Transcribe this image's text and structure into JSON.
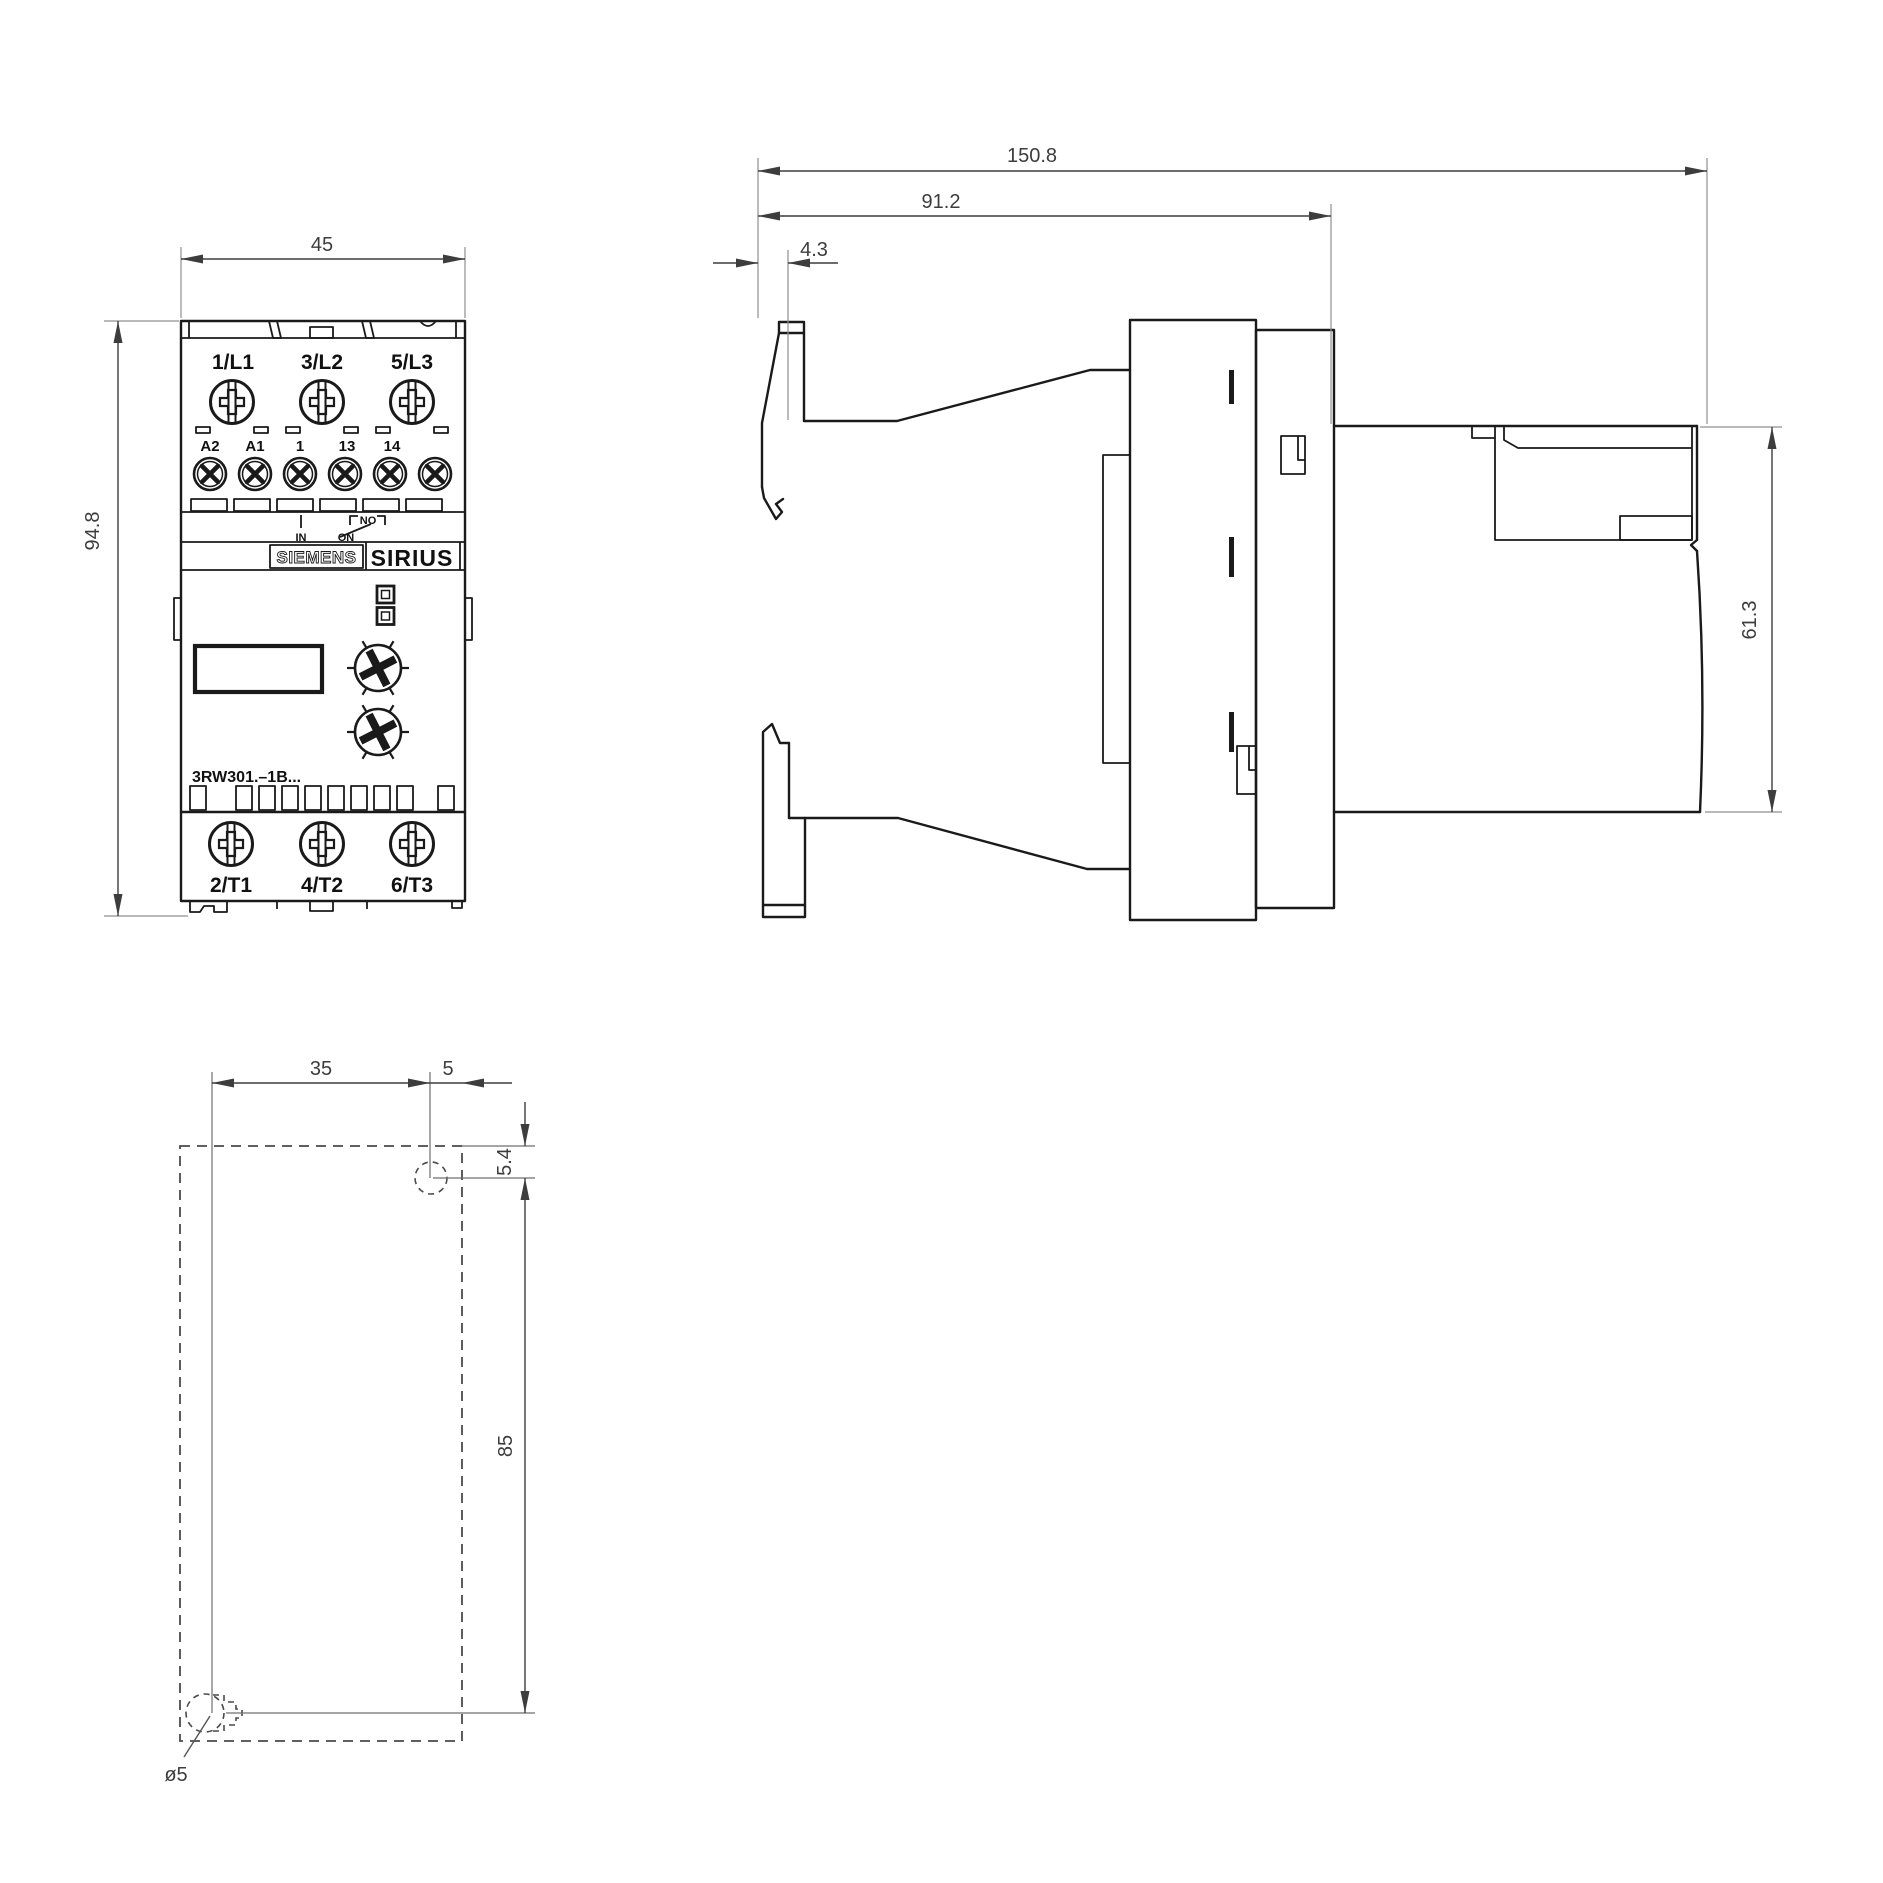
{
  "drawing": {
    "background": "#ffffff",
    "line_color": "#1a1a1a",
    "dim_color": "#3d3d3d"
  },
  "front": {
    "dim_width": "45",
    "dim_height": "94.8",
    "terminals_top": [
      "1/L1",
      "3/L2",
      "5/L3"
    ],
    "terminals_mid": [
      "A2",
      "A1",
      "1",
      "13",
      "14"
    ],
    "marking_in": "IN",
    "marking_on": "ON",
    "marking_no": "NO",
    "brand": "SIEMENS",
    "series": "SIRIUS",
    "model": "3RW301.–1B...",
    "terminals_bottom": [
      "2/T1",
      "4/T2",
      "6/T3"
    ]
  },
  "side": {
    "dim_depth_total": "150.8",
    "dim_depth_body": "91.2",
    "dim_clip_offset": "4.3",
    "dim_rear_height": "61.3"
  },
  "drill": {
    "dim_hole_spacing_h": "35",
    "dim_edge_offset_h": "5",
    "dim_edge_offset_v": "5.4",
    "dim_hole_spacing_v": "85",
    "hole_diameter": "ø5"
  }
}
